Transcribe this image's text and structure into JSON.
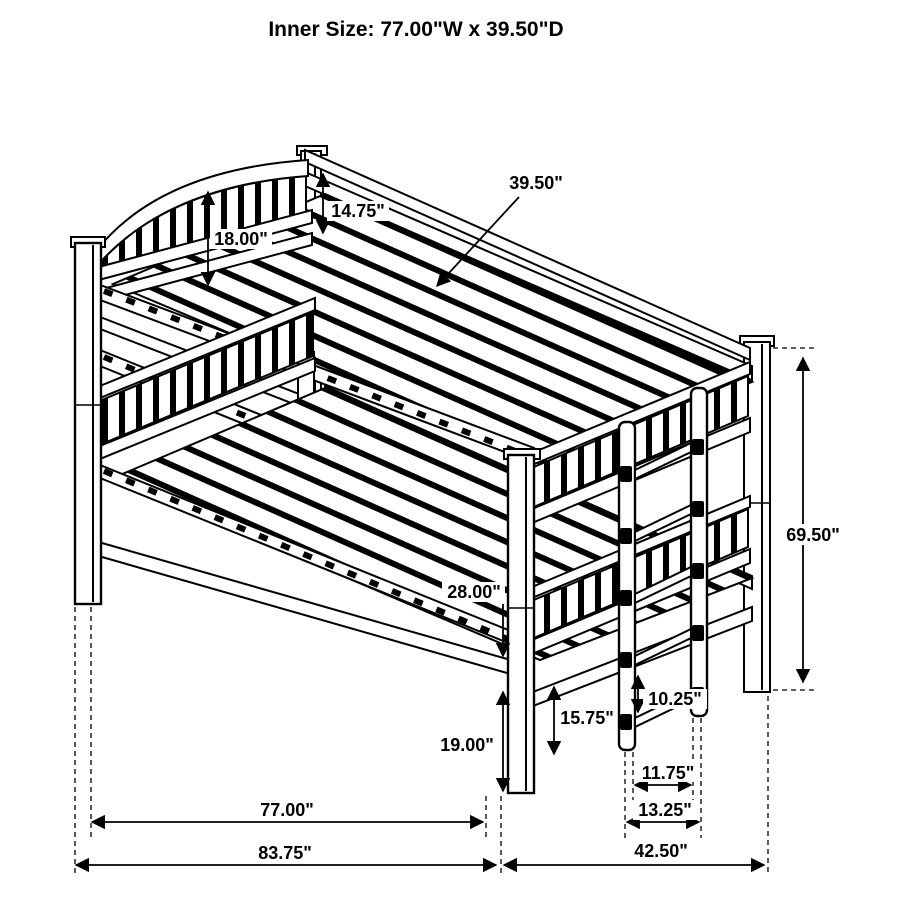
{
  "title": "Inner Size: 77.00\"W x 39.50\"D",
  "colors": {
    "line": "#000000",
    "background": "#ffffff"
  },
  "dimensions": {
    "headboard_height": "18.00\"",
    "guardrail_height": "14.75\"",
    "inner_depth": "39.50\"",
    "overall_height": "69.50\"",
    "bunk_spacing": "28.00\"",
    "under_bed_clearance": "19.00\"",
    "ladder_lower_section": "15.75\"",
    "ladder_rung_spacing": "10.25\"",
    "ladder_inner_width": "11.75\"",
    "ladder_outer_width": "13.25\"",
    "inner_width": "77.00\"",
    "overall_width": "83.75\"",
    "overall_depth": "42.50\""
  }
}
